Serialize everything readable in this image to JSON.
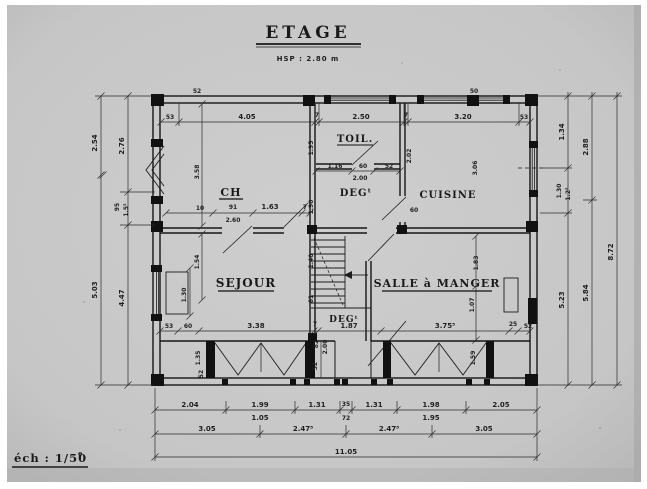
{
  "plan": {
    "title": "ETAGE",
    "hsp": "HSP : 2.80 m",
    "scale": "éch : 1/50",
    "scale_sup": "e",
    "rooms": {
      "ch": "CH",
      "toil": "TOIL.",
      "deg_up": "DEGᵗ",
      "cuisine": "CUISINE",
      "sejour": "SEJOUR",
      "sam": "SALLE à MANGER",
      "deg_low": "DEGᵗ"
    },
    "dims": {
      "top": [
        "53",
        "4.05",
        "7",
        "2.50",
        "7",
        "3.20",
        "53"
      ],
      "top_small": [
        "52",
        "50"
      ],
      "left_a": [
        "2.54",
        "5.03"
      ],
      "left_b": [
        "2.76",
        "95",
        "1.5⁵",
        "4.47"
      ],
      "right_a": [
        "1.34",
        "1.30",
        "1.2⁵",
        "5.23"
      ],
      "right_b": [
        "2.88",
        "5.84"
      ],
      "right_total": "8.72",
      "bot1": [
        "2.04",
        "1.99",
        "1.31",
        "35",
        "1.31",
        "1.98",
        "2.05"
      ],
      "bot1_sub": [
        "1.05",
        "72",
        "1.95"
      ],
      "bot2": [
        "3.05",
        "2.47⁵",
        "2.47⁵",
        "3.05"
      ],
      "bot_total": "11.05",
      "sejour_chain": [
        "53",
        "60",
        "3.38",
        "7",
        "1.87",
        "3.75⁵",
        "25",
        "52"
      ],
      "ch_chain": [
        "10",
        "91",
        "2.60",
        "1.63",
        "7"
      ],
      "toil_chain": [
        "1.16",
        "60",
        "52",
        "2.00"
      ],
      "v": {
        "ch_left": "3.58",
        "sejour_left1": "1.54",
        "sejour_window": "1.30",
        "toil_left": "1.95",
        "deg_left": "1.90",
        "stair": "1.40",
        "stair2": "61",
        "cuisine_left": "2.02",
        "cuisine_right": "3.06",
        "cuisine_60": "60",
        "hall_82": "82",
        "hall_200": "2.00",
        "hall_52": "52",
        "sam_v1": "1.83",
        "sam_v2": "1.07",
        "band_left": "1.35",
        "band_left2": "52",
        "band_right": "1.59"
      }
    },
    "colors": {
      "paper": "#c9c9c9",
      "ink": "#1a1a1a"
    }
  }
}
